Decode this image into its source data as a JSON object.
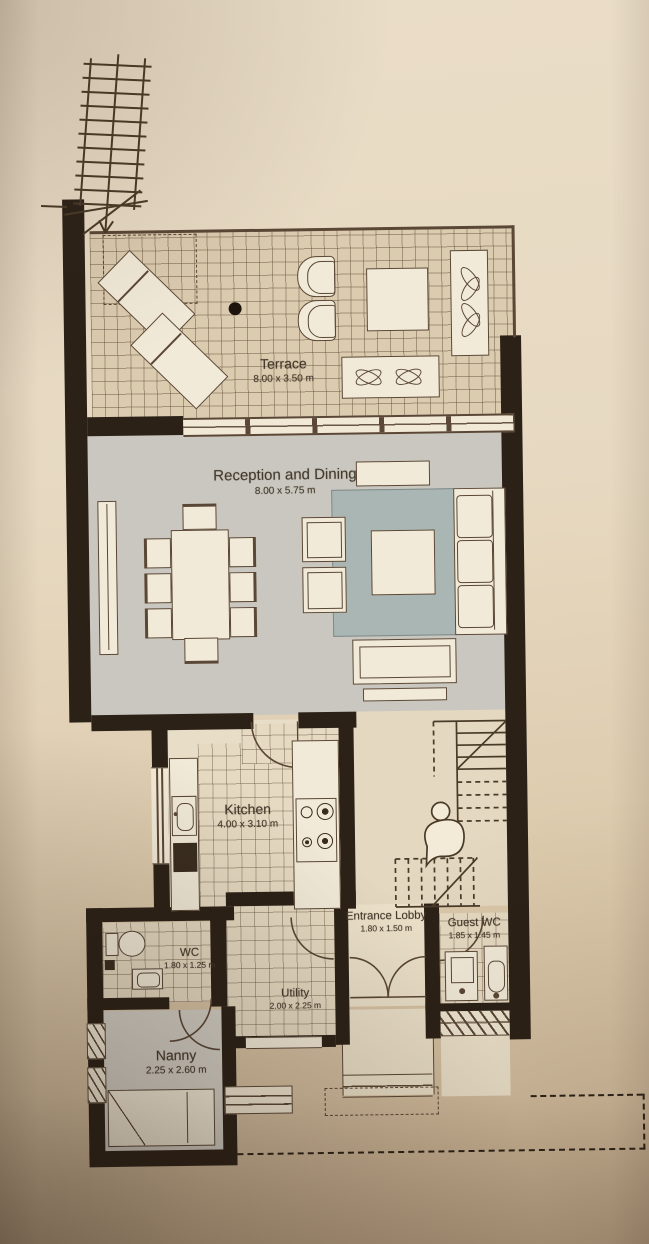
{
  "document_title": "Ground floor plan",
  "rooms": {
    "terrace": {
      "name": "Terrace",
      "dims": "8.00 x 3.50 m"
    },
    "reception": {
      "name": "Reception and Dining",
      "dims": "8.00 x 5.75 m"
    },
    "kitchen": {
      "name": "Kitchen",
      "dims": "4.00 x 3.10 m"
    },
    "wc": {
      "name": "WC",
      "dims": "1.80 x 1.25 m"
    },
    "utility": {
      "name": "Utility",
      "dims": "2.00 x 2.25 m"
    },
    "entrance_lobby": {
      "name": "Entrance Lobby",
      "dims": "1.80 x 1.50 m"
    },
    "guest_wc": {
      "name": "Guest WC",
      "dims": "1.85 x 1.45 m"
    },
    "nanny": {
      "name": "Nanny",
      "dims": "2.25 x 2.60 m"
    }
  },
  "colors": {
    "paper": "#e7dac3",
    "wall": "#2b2117",
    "line": "#5a4735",
    "label": "#43392c",
    "tile": "#dbcbaf",
    "kitchen_tile": "#e6dac2",
    "reception_floor": "#c9c7bf",
    "rug": "#a9b6b4",
    "furniture": "#f2ead8",
    "nanny_floor": "#d4d0c7",
    "porch": "#ece1c9"
  }
}
